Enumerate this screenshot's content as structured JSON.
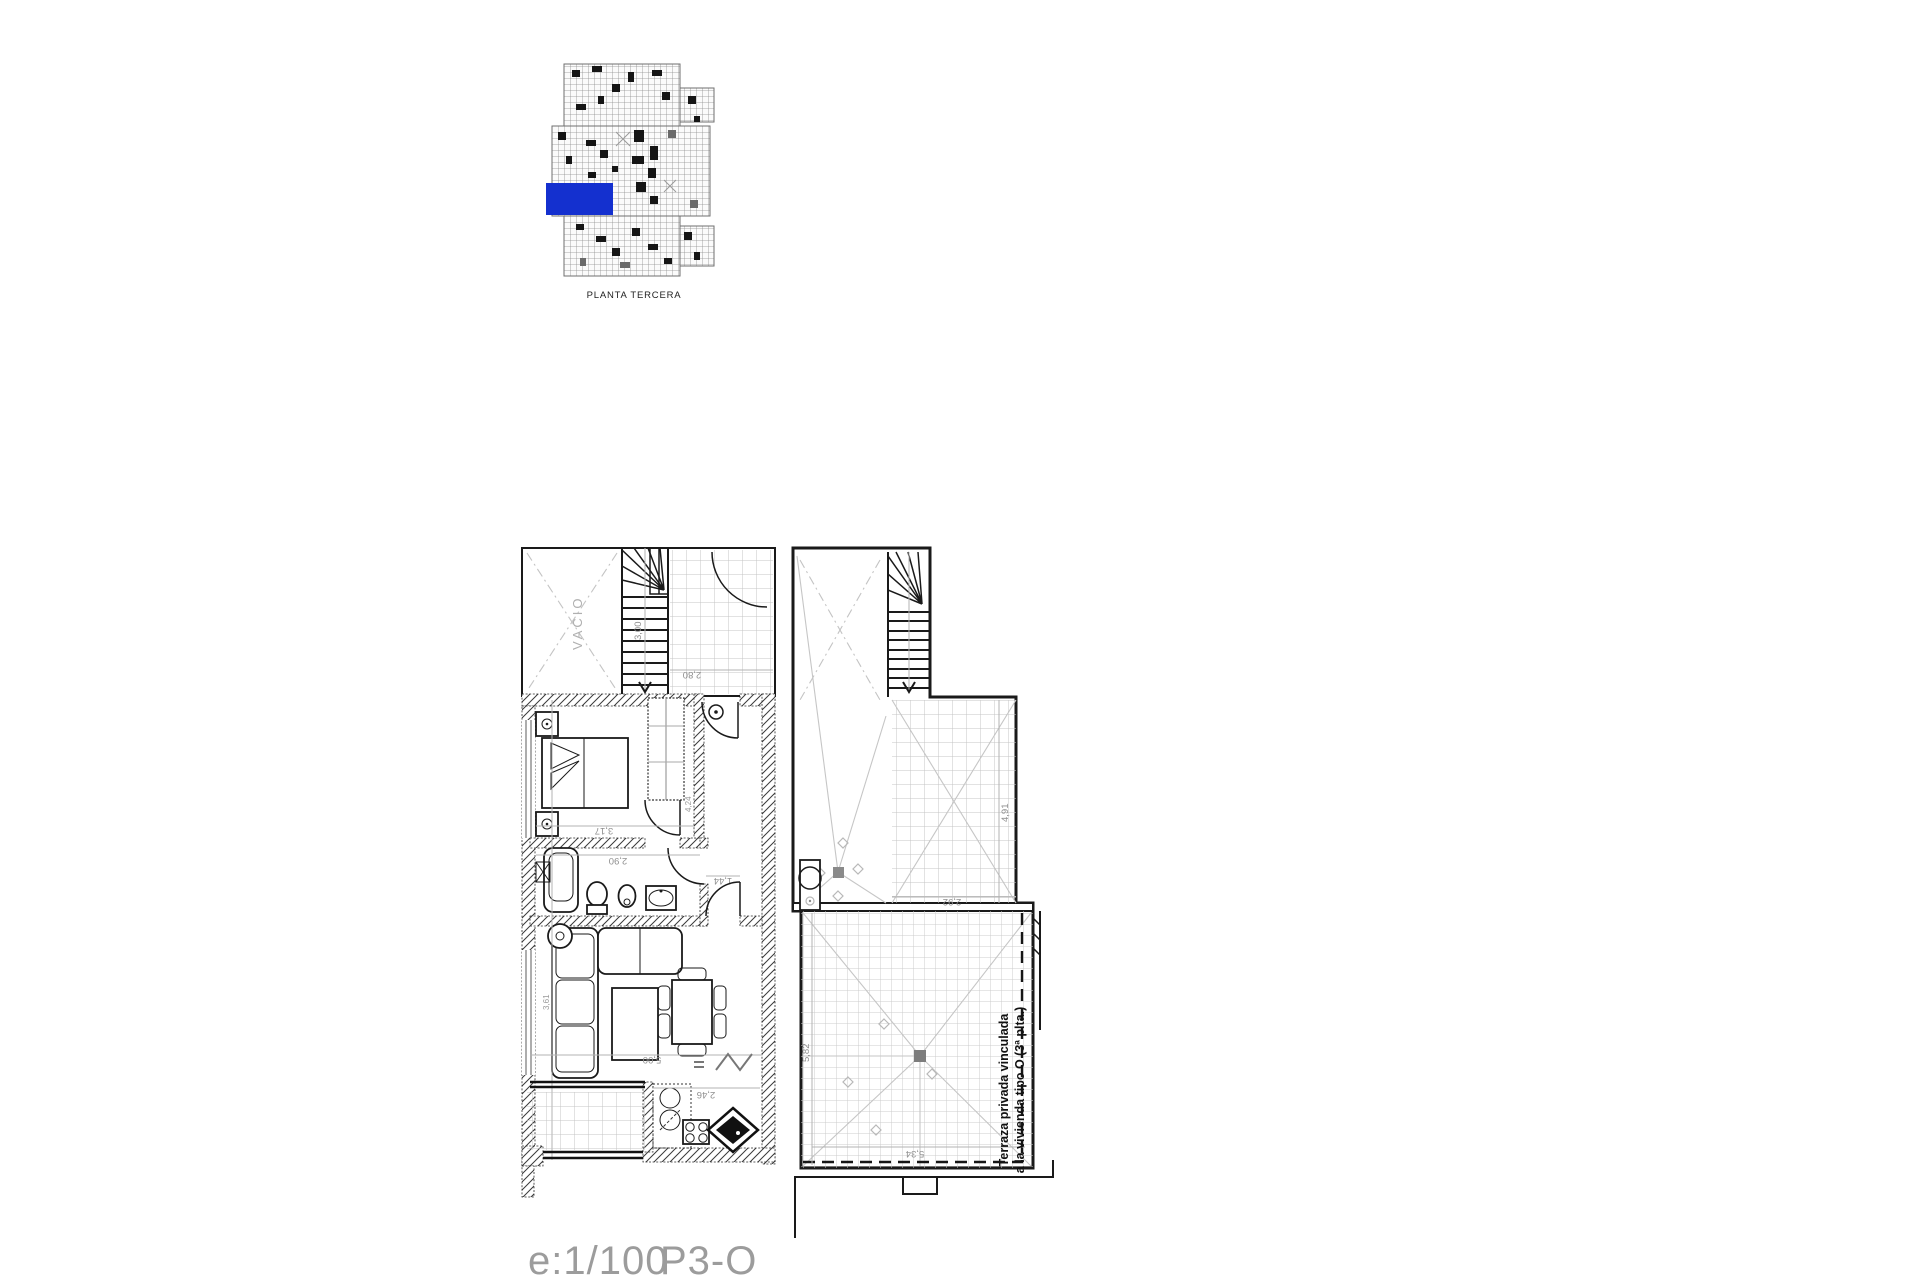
{
  "key_plan": {
    "caption": "PLANTA TERCERA",
    "highlight_color": "#1430cf"
  },
  "floor_plan": {
    "vacio": "VACIO",
    "terrace_note": {
      "line1": "Terraza privada vinculada",
      "line2": "a la vivienda tipo O (3ª plta.)"
    },
    "dimensions": {
      "stair_height": "3,00",
      "hall_width": "2,80",
      "bedroom_width": "3,17",
      "bathroom_width": "2,90",
      "corridor_width": "1,44",
      "wardrobe_length": "4,24",
      "living_width": "5,00",
      "living_height": "3,61",
      "kitchen_width": "2,46",
      "terrace_upper_depth": "4,91",
      "terrace_upper_width": "2,92",
      "terrace_main_depth": "5,82",
      "terrace_main_width": "5,34"
    }
  },
  "footer": {
    "scale": "e:1/100",
    "sheet": "P3-O"
  }
}
